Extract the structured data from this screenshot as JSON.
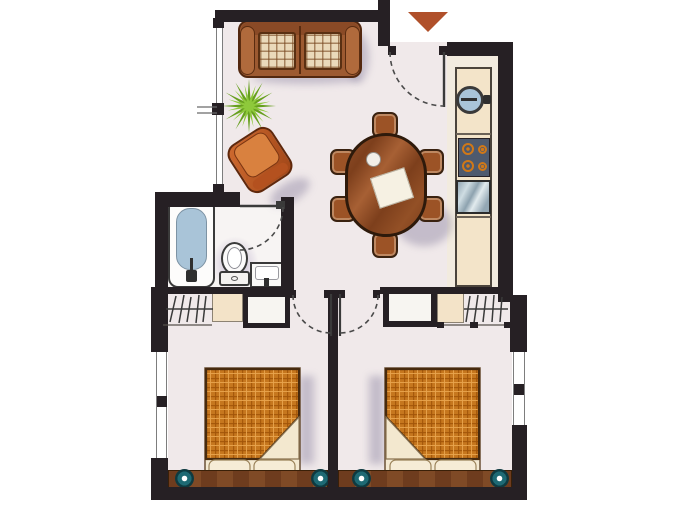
{
  "title": "apartment-floor-plan",
  "palette": {
    "wall": "#262024",
    "floor": "#f0e9ea",
    "bath_floor": "#f7f4f3",
    "counter_beige": "#f3e3c8",
    "wood_table": "#8a4a22",
    "sofa_leather": "#9d5a31",
    "cushion_plaid": "#ead9ba",
    "blanket_orange": "#c6771e",
    "sheet_cream": "#f3e8cf",
    "water_blue": "#a9c4d8",
    "lamp_teal": "#1e6a74",
    "plant_green": "#7db32d",
    "entrance_marker": "#b0502a",
    "stove_top": "#4e5a6e",
    "burner_orange": "#d07818",
    "soft_purple_shadow": "#b3a5c8",
    "line_dark": "#3a3a3a"
  },
  "entrance": {
    "marker": "down-triangle",
    "door": "dashed-swing-arc"
  },
  "rooms": {
    "living_area": {
      "furniture": [
        "two-seat-sofa",
        "potted-plant",
        "armchair"
      ]
    },
    "dining_area": {
      "furniture": [
        "oval-wood-table",
        "chair-top",
        "chair-bottom",
        "chair-left-1",
        "chair-left-2",
        "chair-right-1",
        "chair-right-2",
        "napkin",
        "plate"
      ]
    },
    "kitchen": {
      "counter_items": [
        "round-sink",
        "cooktop-four-burners",
        "glass-front-appliance",
        "worktop"
      ]
    },
    "bathroom": {
      "fixtures": [
        "bathtub",
        "toilet",
        "washbasin"
      ],
      "door": "dashed-swing-arc"
    },
    "wardrobe_left": {
      "items": [
        "hanger-rail",
        "shelf-box",
        "cabinet"
      ]
    },
    "wardrobe_right": {
      "items": [
        "cabinet",
        "shelf-box",
        "hanger-rail"
      ]
    },
    "bedroom_left": {
      "furniture": [
        "double-bed-plaid-blanket",
        "pillow",
        "pillow",
        "headboard",
        "bedside-lamp",
        "bedside-lamp"
      ],
      "window": "left-wall"
    },
    "bedroom_right": {
      "furniture": [
        "double-bed-plaid-blanket",
        "pillow",
        "pillow",
        "headboard",
        "bedside-lamp",
        "bedside-lamp"
      ],
      "window": "right-wall"
    }
  },
  "windows": [
    "living-room-left",
    "bedroom-left",
    "bedroom-right"
  ]
}
